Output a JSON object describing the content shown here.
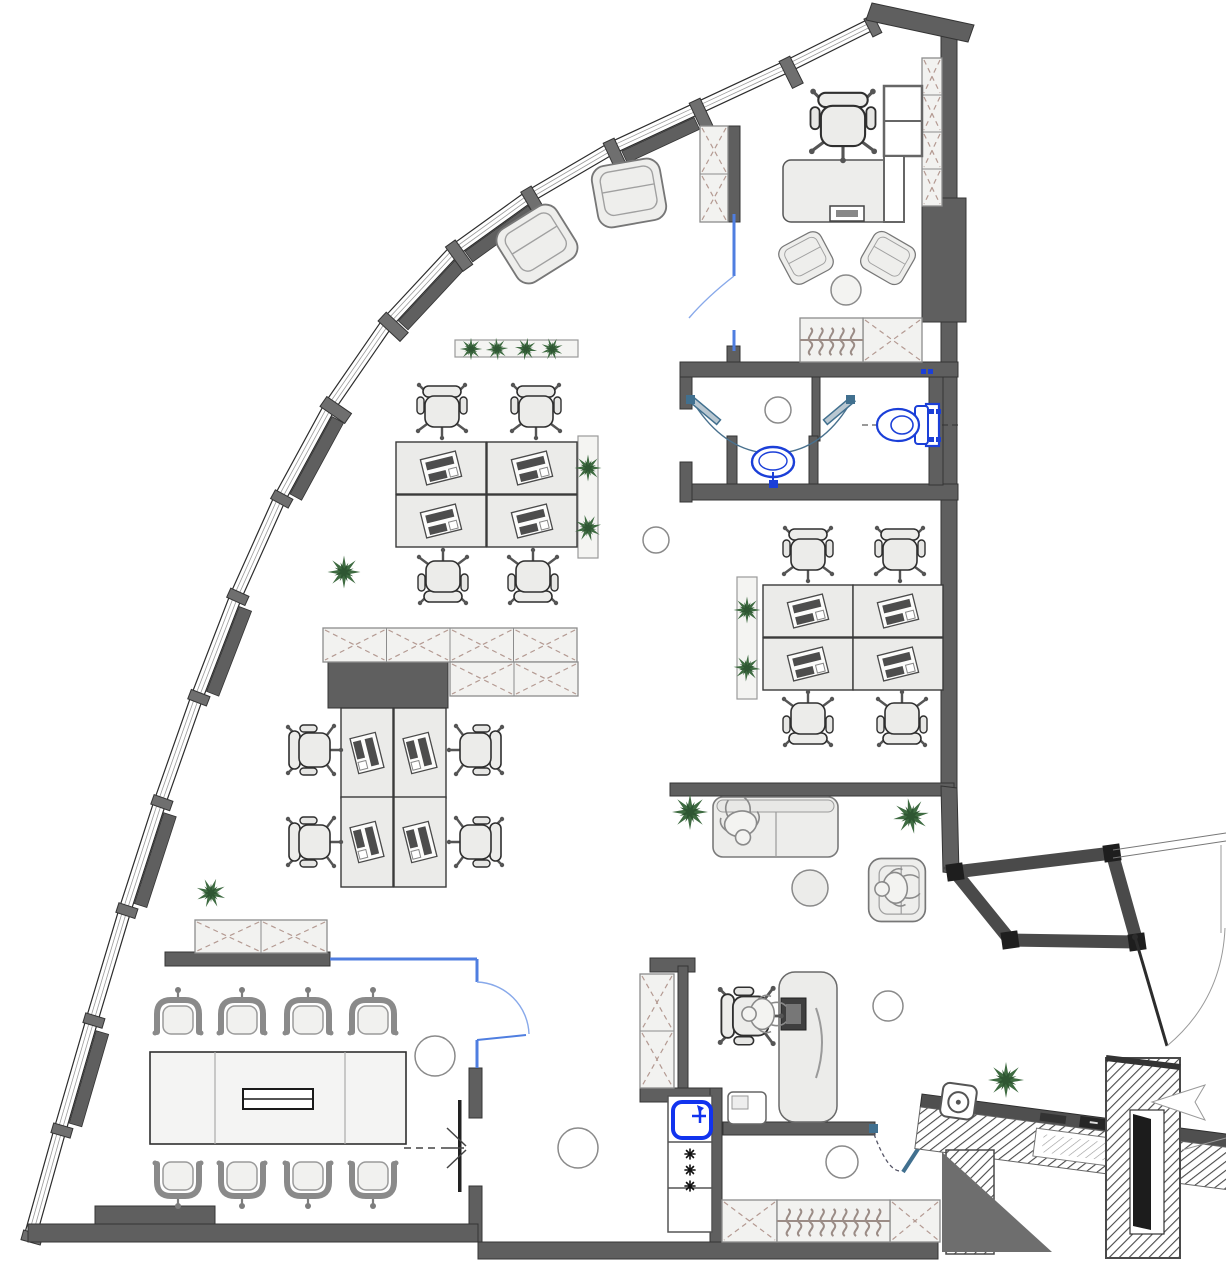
{
  "meta": {
    "title": "office-floor-plan",
    "canvas": {
      "w": 1226,
      "h": 1280
    }
  },
  "palette": {
    "wall": "#5f5f5f",
    "wallEdge": "#343434",
    "mullion": "#6f6f6f",
    "glazingEdge": "#2c2c2c",
    "glazingInner": "#9a9a9a",
    "cabinetFill": "#f2f2f0",
    "cabinetEdge": "#8c8c8c",
    "cabinetX": "#b49a92",
    "planterFill": "#f4f4f2",
    "planterEdge": "#9a9a9a",
    "lightRing": "#8a8a8a",
    "glassBlue": "#4f7ee0",
    "glassArc": "#88a9ea",
    "fixtureBlue": "#1b3fd8",
    "steelBlue": "#41708f",
    "plantGreen": "#3e6b41",
    "plantGreenDark": "#2e5632",
    "furnitureFill": "#ededeb",
    "furnitureEdge": "#555555",
    "hangerColor": "#9b8c86",
    "hatchLine": "#4a4a4a",
    "shadow": "#6e6e6e"
  },
  "areas": [
    "open-workspace",
    "meeting-room",
    "private-office",
    "bathroom",
    "wc",
    "lounge",
    "manager-office",
    "kitchenette",
    "wardrobe",
    "entrance-vestibule",
    "reception-counter"
  ],
  "counts": {
    "desks": 12,
    "task_chairs": 14,
    "meeting_chairs": 8,
    "armchairs": 5,
    "sofas": 1,
    "people": 3,
    "plants": 13,
    "ceiling_lights": 6,
    "window_segments": 15,
    "toilets": 1,
    "washbasins": 1,
    "kitchen_sinks": 1,
    "stove_burners": 3,
    "coat_racks": 2
  },
  "envelope": {
    "joints": [
      [
        30,
        1237
      ],
      [
        60,
        1130
      ],
      [
        92,
        1020
      ],
      [
        125,
        910
      ],
      [
        160,
        802
      ],
      [
        197,
        697
      ],
      [
        236,
        596
      ],
      [
        280,
        498
      ],
      [
        330,
        406
      ],
      [
        388,
        322
      ],
      [
        455,
        250
      ],
      [
        530,
        196
      ],
      [
        612,
        148
      ],
      [
        698,
        108
      ],
      [
        788,
        66
      ],
      [
        872,
        24
      ]
    ],
    "pier_segments": [
      1,
      3,
      5,
      7,
      9,
      10,
      12
    ],
    "heavy_joints": [
      8,
      9,
      10,
      11,
      12,
      13,
      14
    ]
  },
  "walls": [
    {
      "name": "right-wall-top",
      "x": 941,
      "y": 28,
      "w": 16,
      "h": 172
    },
    {
      "name": "column-block",
      "x": 922,
      "y": 198,
      "w": 44,
      "h": 124
    },
    {
      "name": "right-wall",
      "x": 941,
      "y": 322,
      "w": 16,
      "h": 468
    },
    {
      "name": "office-entry-wall",
      "x": 727,
      "y": 126,
      "w": 13,
      "h": 96
    },
    {
      "name": "office-entry-stub",
      "x": 727,
      "y": 346,
      "w": 13,
      "h": 18
    },
    {
      "name": "bathroom-top-wall",
      "x": 680,
      "y": 362,
      "w": 278,
      "h": 15
    },
    {
      "name": "bathroom-left-wall-a",
      "x": 680,
      "y": 377,
      "w": 12,
      "h": 32
    },
    {
      "name": "bathroom-left-wall-b",
      "x": 680,
      "y": 462,
      "w": 12,
      "h": 40
    },
    {
      "name": "bathroom-divider",
      "x": 812,
      "y": 377,
      "w": 8,
      "h": 64
    },
    {
      "name": "vanity-wall-left",
      "x": 727,
      "y": 436,
      "w": 10,
      "h": 52
    },
    {
      "name": "vanity-wall-right",
      "x": 809,
      "y": 436,
      "w": 9,
      "h": 52
    },
    {
      "name": "bathroom-bottom-wall",
      "x": 692,
      "y": 484,
      "w": 266,
      "h": 16
    },
    {
      "name": "wc-right-wall",
      "x": 929,
      "y": 377,
      "w": 14,
      "h": 108
    },
    {
      "name": "lounge-top-wall",
      "x": 670,
      "y": 783,
      "w": 284,
      "h": 13
    },
    {
      "name": "cluster-partition",
      "x": 328,
      "y": 662,
      "w": 120,
      "h": 46
    },
    {
      "name": "meeting-top-wall",
      "x": 165,
      "y": 952,
      "w": 165,
      "h": 14
    },
    {
      "name": "meeting-right-wall-a",
      "x": 469,
      "y": 1068,
      "w": 13,
      "h": 50
    },
    {
      "name": "meeting-right-wall-b",
      "x": 469,
      "y": 1186,
      "w": 13,
      "h": 56
    },
    {
      "name": "bottom-wall-left",
      "x": 28,
      "y": 1224,
      "w": 450,
      "h": 18
    },
    {
      "name": "bottom-wall-block",
      "x": 95,
      "y": 1206,
      "w": 120,
      "h": 18
    },
    {
      "name": "bottom-wall-right",
      "x": 478,
      "y": 1242,
      "w": 460,
      "h": 17
    },
    {
      "name": "kitchen-top-stub",
      "x": 650,
      "y": 958,
      "w": 45,
      "h": 14
    },
    {
      "name": "kitchen-left-wall",
      "x": 678,
      "y": 966,
      "w": 10,
      "h": 126
    },
    {
      "name": "kitchen-mid-wall",
      "x": 640,
      "y": 1088,
      "w": 80,
      "h": 14
    },
    {
      "name": "kitchen-right-wall",
      "x": 710,
      "y": 1088,
      "w": 12,
      "h": 154
    },
    {
      "name": "office-bottom-wall",
      "x": 723,
      "y": 1122,
      "w": 152,
      "h": 13
    }
  ],
  "wall_polygons": [
    {
      "name": "top-cap-wall",
      "points": "872,3 974,25 968,42 866,20"
    },
    {
      "name": "vestibule-connector",
      "points": "941,786 957,788 959,874 943,872"
    }
  ],
  "cabinets": [
    {
      "x": 195,
      "y": 920,
      "w": 132,
      "h": 33,
      "cols": 2,
      "rows": 1
    },
    {
      "x": 323,
      "y": 628,
      "w": 254,
      "h": 34,
      "cols": 4,
      "rows": 1
    },
    {
      "x": 450,
      "y": 662,
      "w": 128,
      "h": 34,
      "cols": 2,
      "rows": 1
    },
    {
      "x": 640,
      "y": 974,
      "w": 34,
      "h": 114,
      "cols": 1,
      "rows": 2
    },
    {
      "x": 700,
      "y": 126,
      "w": 28,
      "h": 96,
      "cols": 1,
      "rows": 2
    },
    {
      "x": 922,
      "y": 58,
      "w": 20,
      "h": 148,
      "cols": 1,
      "rows": 4
    },
    {
      "x": 863,
      "y": 318,
      "w": 59,
      "h": 44,
      "cols": 1,
      "rows": 1
    },
    {
      "x": 722,
      "y": 1200,
      "w": 55,
      "h": 42,
      "cols": 1,
      "rows": 1
    },
    {
      "x": 890,
      "y": 1200,
      "w": 50,
      "h": 42,
      "cols": 1,
      "rows": 1
    }
  ],
  "hanger_racks": [
    {
      "x": 800,
      "y": 318,
      "w": 63,
      "h": 44,
      "count": 5
    },
    {
      "x": 777,
      "y": 1200,
      "w": 113,
      "h": 42,
      "count": 9
    }
  ],
  "planters": [
    {
      "x": 455,
      "y": 340,
      "w": 123,
      "h": 17
    },
    {
      "x": 578,
      "y": 436,
      "w": 20,
      "h": 122
    },
    {
      "x": 737,
      "y": 577,
      "w": 20,
      "h": 122
    }
  ],
  "lights": [
    {
      "cx": 656,
      "cy": 540,
      "r": 13
    },
    {
      "cx": 778,
      "cy": 410,
      "r": 13
    },
    {
      "cx": 888,
      "cy": 1006,
      "r": 15
    },
    {
      "cx": 435,
      "cy": 1056,
      "r": 20
    },
    {
      "cx": 578,
      "cy": 1148,
      "r": 20
    },
    {
      "cx": 842,
      "cy": 1162,
      "r": 16
    }
  ],
  "furniture": [
    {
      "type": "desk",
      "x": 441,
      "y": 468,
      "rot": 0
    },
    {
      "type": "desk",
      "x": 532,
      "y": 468,
      "rot": 0
    },
    {
      "type": "desk",
      "x": 441,
      "y": 521,
      "rot": 0
    },
    {
      "type": "desk",
      "x": 532,
      "y": 521,
      "rot": 0
    },
    {
      "type": "desk",
      "x": 367,
      "y": 753,
      "rot": 90
    },
    {
      "type": "desk",
      "x": 420,
      "y": 753,
      "rot": 90
    },
    {
      "type": "desk",
      "x": 367,
      "y": 842,
      "rot": 90
    },
    {
      "type": "desk",
      "x": 420,
      "y": 842,
      "rot": 90
    },
    {
      "type": "desk",
      "x": 808,
      "y": 611,
      "rot": 0
    },
    {
      "type": "desk",
      "x": 898,
      "y": 611,
      "rot": 0
    },
    {
      "type": "desk",
      "x": 808,
      "y": 664,
      "rot": 0
    },
    {
      "type": "desk",
      "x": 898,
      "y": 664,
      "rot": 0
    },
    {
      "type": "task-chair",
      "x": 442,
      "y": 410,
      "rot": 0
    },
    {
      "type": "task-chair",
      "x": 536,
      "y": 410,
      "rot": 0
    },
    {
      "type": "task-chair",
      "x": 443,
      "y": 578,
      "rot": 180
    },
    {
      "type": "task-chair",
      "x": 533,
      "y": 578,
      "rot": 180
    },
    {
      "type": "task-chair",
      "x": 313,
      "y": 750,
      "rot": -90
    },
    {
      "type": "task-chair",
      "x": 313,
      "y": 842,
      "rot": -90
    },
    {
      "type": "task-chair",
      "x": 477,
      "y": 750,
      "rot": 90
    },
    {
      "type": "task-chair",
      "x": 477,
      "y": 842,
      "rot": 90
    },
    {
      "type": "task-chair",
      "x": 808,
      "y": 553,
      "rot": 0
    },
    {
      "type": "task-chair",
      "x": 900,
      "y": 553,
      "rot": 0
    },
    {
      "type": "task-chair",
      "x": 808,
      "y": 720,
      "rot": 180
    },
    {
      "type": "task-chair",
      "x": 902,
      "y": 720,
      "rot": 180
    },
    {
      "type": "task-chair",
      "x": 843,
      "y": 124,
      "rot": 0,
      "scale": 1.3
    },
    {
      "type": "task-chair",
      "x": 749,
      "y": 1016,
      "rot": -90,
      "scale": 1.15
    },
    {
      "type": "meeting-chair",
      "x": 178,
      "y": 1020,
      "rot": 0
    },
    {
      "type": "meeting-chair",
      "x": 242,
      "y": 1020,
      "rot": 0
    },
    {
      "type": "meeting-chair",
      "x": 308,
      "y": 1020,
      "rot": 0
    },
    {
      "type": "meeting-chair",
      "x": 373,
      "y": 1020,
      "rot": 0
    },
    {
      "type": "meeting-chair",
      "x": 178,
      "y": 1176,
      "rot": 180
    },
    {
      "type": "meeting-chair",
      "x": 242,
      "y": 1176,
      "rot": 180
    },
    {
      "type": "meeting-chair",
      "x": 308,
      "y": 1176,
      "rot": 180
    },
    {
      "type": "meeting-chair",
      "x": 373,
      "y": 1176,
      "rot": 180
    },
    {
      "type": "armchair",
      "x": 537,
      "y": 244,
      "rot": -32,
      "scale": 1.15
    },
    {
      "type": "armchair",
      "x": 629,
      "y": 193,
      "rot": -10,
      "scale": 1.15
    },
    {
      "type": "armchair",
      "x": 806,
      "y": 258,
      "rot": -28,
      "scale": 0.78
    },
    {
      "type": "armchair",
      "x": 888,
      "y": 258,
      "rot": 30,
      "scale": 0.78
    },
    {
      "type": "armchair",
      "x": 897,
      "y": 890,
      "rot": 90,
      "scale": 1.05
    },
    {
      "type": "plant",
      "x": 471,
      "y": 349,
      "rot": 0,
      "scale": 0.75
    },
    {
      "type": "plant",
      "x": 497,
      "y": 349,
      "rot": 40,
      "scale": 0.75
    },
    {
      "type": "plant",
      "x": 526,
      "y": 349,
      "rot": 10,
      "scale": 0.75
    },
    {
      "type": "plant",
      "x": 552,
      "y": 349,
      "rot": 70,
      "scale": 0.75
    },
    {
      "type": "plant",
      "x": 588,
      "y": 468,
      "rot": 0,
      "scale": 0.9
    },
    {
      "type": "plant",
      "x": 588,
      "y": 528,
      "rot": 30,
      "scale": 0.9
    },
    {
      "type": "plant",
      "x": 747,
      "y": 610,
      "rot": 0,
      "scale": 0.9
    },
    {
      "type": "plant",
      "x": 747,
      "y": 668,
      "rot": 50,
      "scale": 0.9
    },
    {
      "type": "plant",
      "x": 344,
      "y": 572,
      "rot": 0,
      "scale": 1.1
    },
    {
      "type": "plant",
      "x": 211,
      "y": 893,
      "rot": 20,
      "scale": 1.0
    },
    {
      "type": "plant",
      "x": 690,
      "y": 812,
      "rot": 0,
      "scale": 1.2
    },
    {
      "type": "plant",
      "x": 911,
      "y": 816,
      "rot": 35,
      "scale": 1.2
    },
    {
      "type": "plant",
      "x": 1006,
      "y": 1080,
      "rot": 0,
      "scale": 1.2
    },
    {
      "type": "person",
      "x": 741,
      "y": 826,
      "rot": 170,
      "scale": 1.15
    },
    {
      "type": "person",
      "x": 893,
      "y": 888,
      "rot": -95,
      "scale": 1.1
    },
    {
      "type": "person",
      "x": 760,
      "y": 1014,
      "rot": -90,
      "scale": 1.1
    }
  ]
}
